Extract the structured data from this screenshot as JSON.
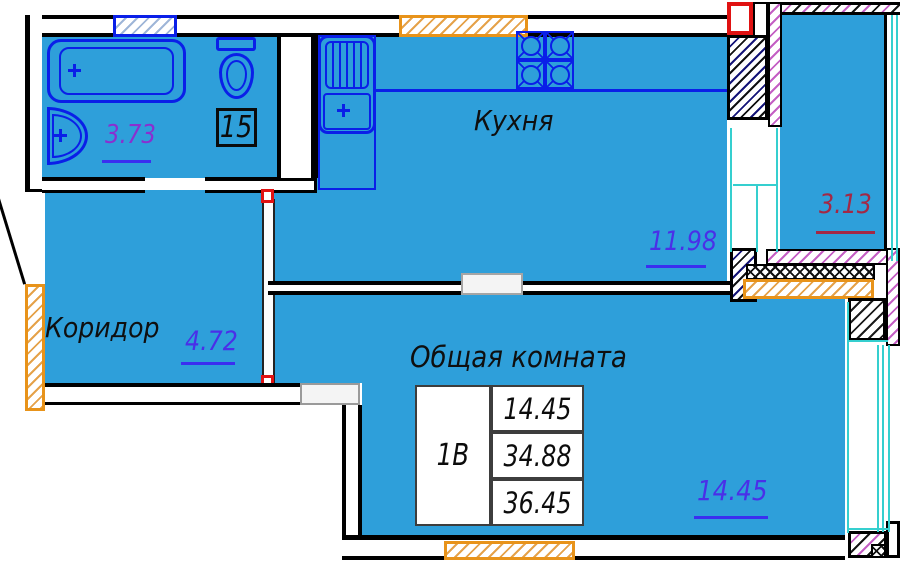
{
  "rooms": {
    "bathroom": {
      "area": "3.73"
    },
    "kitchen": {
      "label": "Кухня",
      "area": "11.98"
    },
    "corridor": {
      "label": "Коридор",
      "area": "4.72"
    },
    "living_room": {
      "label": "Общая комната",
      "area": "14.45"
    },
    "balcony": {
      "area": "3.13"
    }
  },
  "unit_number": "15",
  "info_table": {
    "apartment_type": "1В",
    "rows": [
      "14.45",
      "34.88",
      "36.45"
    ]
  },
  "colors": {
    "room_fill": "#2E9FDA",
    "plumbing_blue": "#0A1FE8",
    "area_label_blue": "#4A2FE8",
    "bathroom_area_purple": "#8A2FD0",
    "balcony_area_red": "#A32845",
    "window_orange": "#E8931A",
    "glazing_cyan": "#35CFCF",
    "vent_red": "#E01212"
  }
}
